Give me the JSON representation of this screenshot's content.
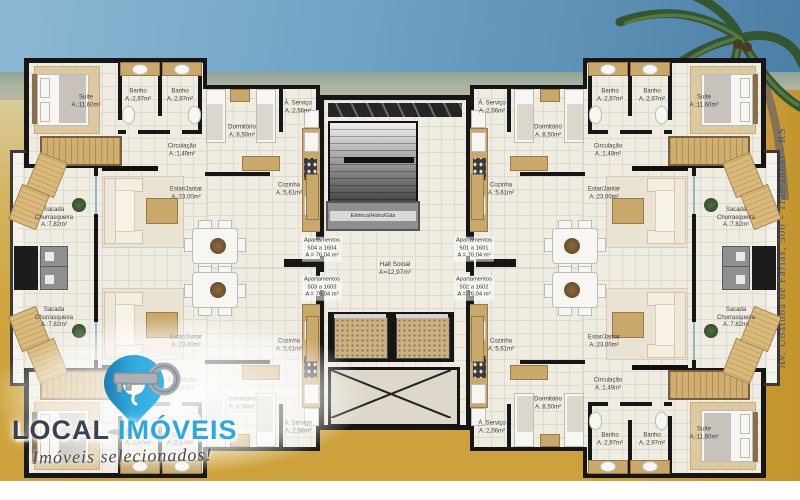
{
  "colors": {
    "brand_blue": "#2aa9e0",
    "brand_dark": "#3a424d",
    "sand_gold": "#cfa43c",
    "address_blue": "#3e5a7b"
  },
  "logo": {
    "name_part1": "LOCAL",
    "name_part2": "IMÓVEIS",
    "tagline": "Imóveis selecionados!",
    "icon": "pin-with-key-icon"
  },
  "address": "Av. Ubatuba de Farias, 500 - Tramandaí - RS",
  "plan": {
    "rooms": {
      "suite": {
        "name": "Suíte",
        "area": "A.:11,60m²"
      },
      "banho": {
        "name": "Banho",
        "area": "A.:2,97m²"
      },
      "dormitorio": {
        "name": "Dormitório",
        "area": "A.:8,50m²"
      },
      "circulacao": {
        "name": "Circulação",
        "area": "A.:1,49m²"
      },
      "estar_jantar": {
        "name": "Estar/Jantar",
        "area": "A.:23,00m²"
      },
      "sacada": {
        "name1": "Sacada",
        "name2": "Churrasqueira",
        "area": "A.:7,82m²"
      },
      "cozinha": {
        "name": "Cozinha",
        "area": "A.:5,61m²"
      },
      "servico": {
        "name": "Á. Serviço",
        "area": "A.:2,56m²"
      }
    },
    "core": {
      "eletrica": "Elétrica/Hidro/Gás",
      "hall_name": "Hall Social",
      "hall_area": "A=12,97m²"
    },
    "units": [
      {
        "title": "Apartamentos",
        "range": "504 a 1604",
        "area": "A = 76,04 m²"
      },
      {
        "title": "Apartamentos",
        "range": "501 a 1601",
        "area": "A = 76,04 m²"
      },
      {
        "title": "Apartamentos",
        "range": "503 a 1603",
        "area": "A = 76,04 m²"
      },
      {
        "title": "Apartamentos",
        "range": "502 a 1602",
        "area": "A = 76,04 m²"
      }
    ]
  }
}
